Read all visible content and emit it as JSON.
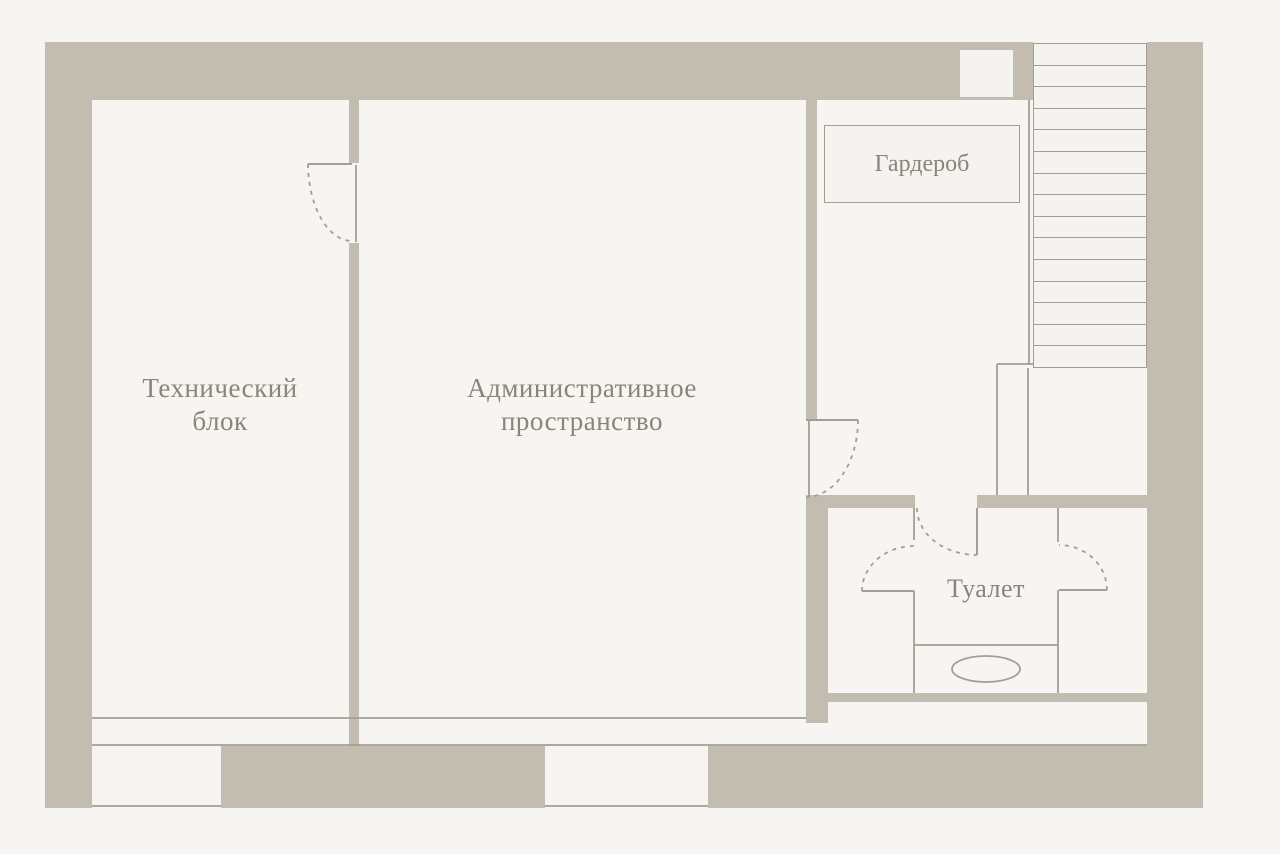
{
  "plan": {
    "title": "Floor plan",
    "rooms": {
      "tech_block": {
        "label": "Технический блок"
      },
      "admin_space": {
        "label": "Административное пространство"
      },
      "wardrobe": {
        "label": "Гардероб"
      },
      "toilet": {
        "label": "Туалет"
      }
    },
    "stairs": {
      "steps": 15
    },
    "fixtures": {
      "basin": "oval-basin"
    },
    "colors": {
      "wall": "#c3bcb1",
      "floor": "#f5f3ef",
      "line": "#a49e92",
      "text": "#8b8478",
      "background": "#f6f5f1"
    }
  }
}
